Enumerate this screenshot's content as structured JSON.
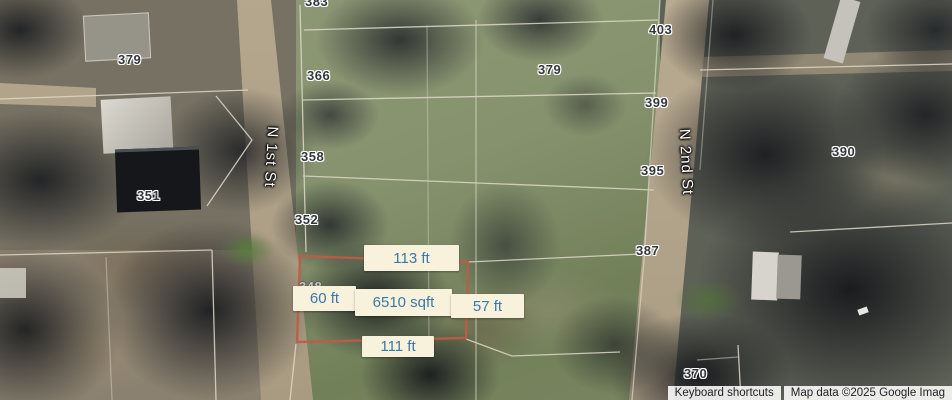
{
  "map": {
    "streets": {
      "first": "N 1st St",
      "second": "N 2nd St"
    },
    "addresses": [
      {
        "text": "383"
      },
      {
        "text": "403"
      },
      {
        "text": "379"
      },
      {
        "text": "366"
      },
      {
        "text": "379"
      },
      {
        "text": "399"
      },
      {
        "text": "390"
      },
      {
        "text": "358"
      },
      {
        "text": "395"
      },
      {
        "text": "351"
      },
      {
        "text": "352"
      },
      {
        "text": "387"
      },
      {
        "text": "348"
      },
      {
        "text": "370"
      }
    ],
    "selected_parcel": {
      "top_length": "113 ft",
      "left_length": "60 ft",
      "area": "6510 sqft",
      "right_length": "57 ft",
      "bottom_length": "111 ft"
    },
    "attribution": {
      "keyboard_shortcuts": "Keyboard shortcuts",
      "map_data": "Map data ©2025 Google Imag"
    },
    "colors": {
      "parcel_highlight": "#bf5b47",
      "measurement_bg": "#f8f1dc",
      "measurement_text": "#3c78a8",
      "parcel_line": "#ded8c8"
    }
  }
}
